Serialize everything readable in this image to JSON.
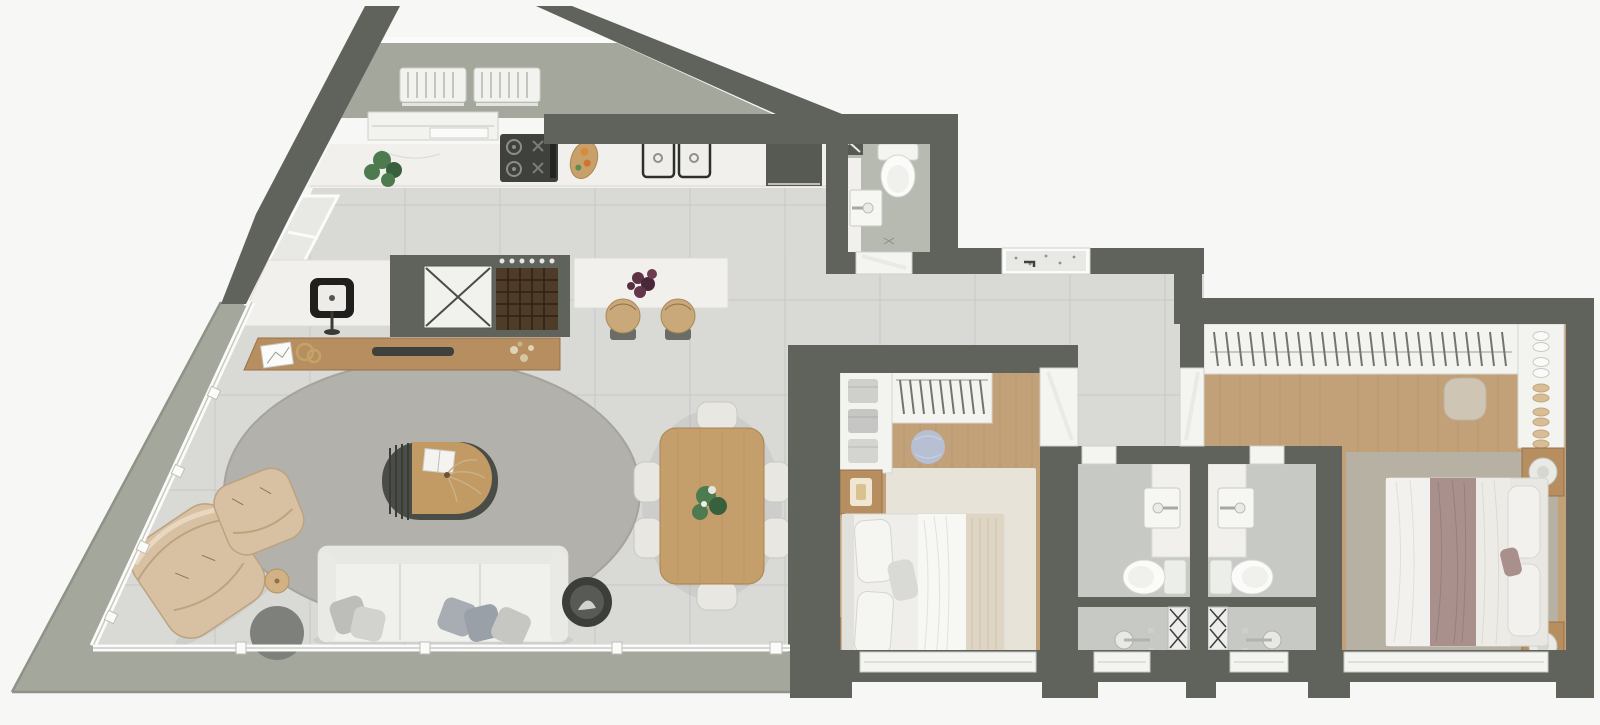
{
  "meta": {
    "title": "apartment-floor-plan-top-view",
    "style": "3d-rendered top-down floor plan, no text labels"
  },
  "colors": {
    "bg": "#f7f7f5",
    "wall": "#60635c",
    "wall_dark": "#54574f",
    "tile": "#d9d9d6",
    "grout": "#c7c7c4",
    "tile_bath": "#c7c9c4",
    "tile_service": "#b7bab1",
    "terrace": "#a4a79b",
    "terrace_edge": "#8f9287",
    "wood": "#c2a179",
    "plank": "#a5855e",
    "marble": "#f1f0ed",
    "marble_line": "#d9d8d4",
    "granite": "#e8e8e4",
    "white_soft": "#f3f3f0",
    "white_stroke": "#d7d7d3",
    "furn_wood": "#b68e5f",
    "furn_wood_dark": "#97734a",
    "sofa": "#f0f0ed",
    "leather": "#d8c0a2",
    "leather_line": "#bda37d",
    "rug_living": "#b3b1ab",
    "rug_b1": "#e7e3d8",
    "rug_master": "#b7b1a4",
    "pouf_blue": "#b7c0d3",
    "pouf_beige": "#cfc5b5",
    "dark": "#3f423c",
    "appliance": "#575a52",
    "mid_gray": "#7e817b",
    "mauve": "#a9908c",
    "plant": "#4e7a50",
    "plant_dark": "#39603c",
    "metal": "#8f8f8c",
    "glass": "#eef0ee",
    "door_leaf": "#e9e9e5"
  },
  "rooms": {
    "technical_balcony": {
      "label": "technical balcony with two condenser units",
      "items": [
        "ac-unit",
        "ac-unit",
        "railing"
      ]
    },
    "kitchen": {
      "label": "kitchen",
      "items": [
        "marble-counter",
        "potted-plant",
        "gas-cooktop",
        "cutting-board",
        "double-sink",
        "fridge",
        "island-counter",
        "fruit-bowl",
        "stool",
        "stool",
        "bar-counter",
        "bar-sink",
        "shaft",
        "wine-rack"
      ]
    },
    "living_room": {
      "label": "living room",
      "items": [
        "sideboard",
        "picture-frame",
        "decor-rings",
        "tv",
        "flowers",
        "oval-rug",
        "coffee-table",
        "book",
        "dried-plant",
        "sofa",
        "pillows",
        "leather-armchair",
        "leather-ottoman",
        "round-side-table",
        "round-coffee-side-table",
        "decor-bowl"
      ]
    },
    "dining_area": {
      "label": "dining area",
      "items": [
        "wood-table",
        "chair",
        "chair",
        "chair",
        "chair",
        "chair",
        "chair",
        "centerpiece-plant"
      ]
    },
    "terrace": {
      "label": "wrap-around terrace",
      "items": [
        "glass-wall"
      ]
    },
    "service_bathroom": {
      "label": "service bathroom",
      "items": [
        "toilet",
        "wall-sink",
        "shaft"
      ]
    },
    "laundry_niche": {
      "label": "laundry niche",
      "items": [
        "granite-tub",
        "faucet"
      ]
    },
    "hallway": {
      "label": "hallway",
      "items": []
    },
    "bedroom_1": {
      "label": "bedroom 1",
      "items": [
        "open-closet",
        "folded-clothes",
        "hangers",
        "round-pouf",
        "rug",
        "double-bed",
        "nightstand",
        "nightstand",
        "window"
      ]
    },
    "bathroom_social": {
      "label": "bathroom",
      "items": [
        "vanity-sink",
        "toilet",
        "shower",
        "drain",
        "window"
      ]
    },
    "bathroom_ensuite": {
      "label": "en-suite bathroom",
      "items": [
        "vanity-sink",
        "toilet",
        "shower",
        "drain",
        "window"
      ]
    },
    "master_bedroom": {
      "label": "master bedroom",
      "items": [
        "wardrobe-rail",
        "hangers",
        "shoe-shelf",
        "square-pouf",
        "rug",
        "double-bed",
        "nightstand",
        "nightstand",
        "table-lamp",
        "table-lamp",
        "wall-tv",
        "window"
      ]
    }
  }
}
